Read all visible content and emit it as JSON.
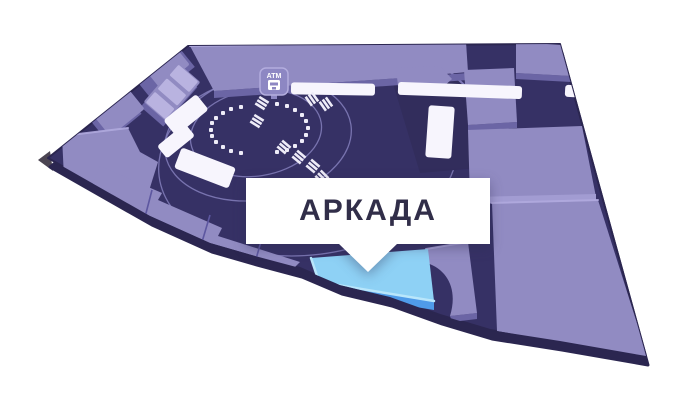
{
  "map": {
    "type": "mall-indoor-floor-plan",
    "view": "3d-perspective",
    "callout": {
      "label": "АРКАДА"
    },
    "atm": {
      "label": "ATM"
    },
    "selected_store": {
      "name": "АРКАДА",
      "status": "highlighted"
    },
    "colors": {
      "background": "#FFFFFF",
      "edge": "#2B2650",
      "floor": "#363165",
      "block_dark": "#322D5C",
      "store_top": "#918BC2",
      "store_side": "#6B65A5",
      "store_bevel": "#A29CD2",
      "step_cell": "#B9B3E0",
      "kiosk": "#F7F5FD",
      "walkway_line": "#8A84C2",
      "divider": "#5D57A0",
      "seat": "#EEECF8",
      "atm_fill": "#8D87C3",
      "atm_border": "#B3ADDE",
      "highlight_top": "#8ED1F5",
      "highlight_bevel": "#B9E6FB",
      "highlight_side": "#4F9BE9",
      "callout_bg": "#FFFFFF",
      "callout_text": "#312E49",
      "tip_shadow": "#4B4552"
    }
  }
}
